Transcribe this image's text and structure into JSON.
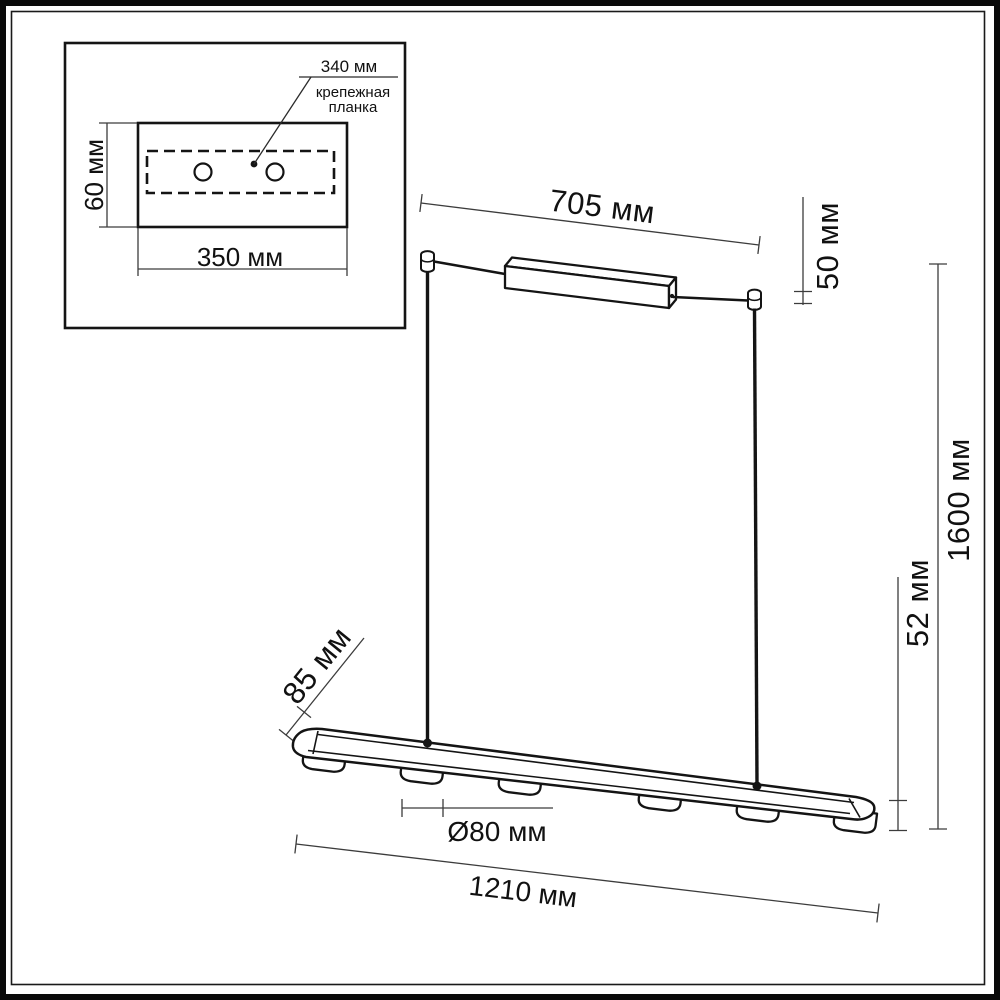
{
  "diagram": {
    "type": "technical-dimension-drawing",
    "inset": {
      "hole_spacing": "340 мм",
      "plate_name_line1": "крепежная",
      "plate_name_line2": "планка",
      "plate_height": "60 мм",
      "plate_width": "350 мм"
    },
    "dimensions": {
      "canopy_span": "705 мм",
      "grip_height": "50 мм",
      "suspension_drop": "1600 мм",
      "bar_depth": "85 мм",
      "fixture_height": "52 мм",
      "spot_diameter": "Ø80 мм",
      "bar_length": "1210 мм"
    },
    "colors": {
      "line": "#141414",
      "dimension_line": "#3c3c3c",
      "background": "#ffffff"
    }
  }
}
